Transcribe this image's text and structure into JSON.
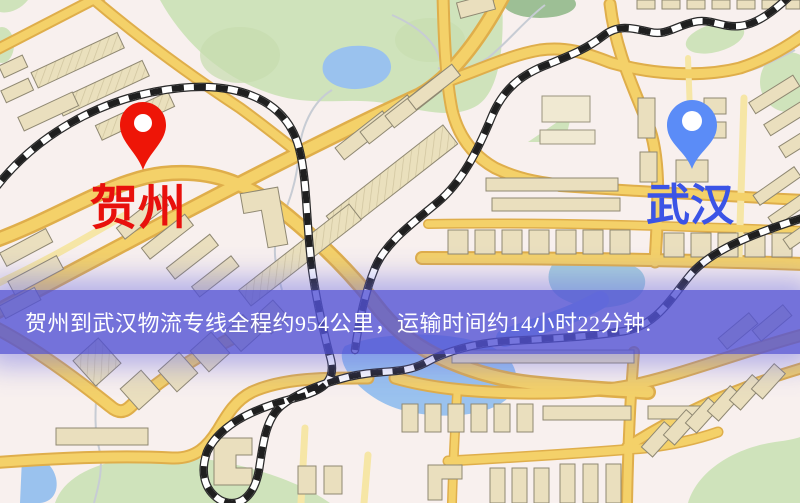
{
  "page": {
    "type": "logistics-route-map-graphic",
    "width": 800,
    "height": 503
  },
  "markers": {
    "origin": {
      "name": "贺州",
      "pin_color": "#ee1507",
      "pin_inner_color": "#ffffff",
      "label_color": "#e8100c"
    },
    "destination": {
      "name": "武汉",
      "pin_color": "#5b8cf7",
      "pin_inner_color": "#ffffff",
      "label_color": "#3b54e6"
    }
  },
  "banner": {
    "text": "贺州到武汉物流专线全程约954公里，运输时间约14小时22分钟.",
    "origin": "贺州",
    "destination": "武汉",
    "distance": "约954公里",
    "duration": "约14小时22分钟",
    "bg_color": "#5252d5",
    "text_color": "#ffffff"
  },
  "map": {
    "style": "street-map",
    "colors": {
      "background": "#f8f0ee",
      "road_fill": "#f4d169",
      "road_casing": "#dfae4b",
      "minor_road": "#f6e6a6",
      "building": "#eadfbe",
      "building_outline": "#8f8872",
      "park": "#cfe3bb",
      "water": "#9ac2ee",
      "railway_dark": "#1f1f1f",
      "railway_light": "#ffffff"
    }
  }
}
